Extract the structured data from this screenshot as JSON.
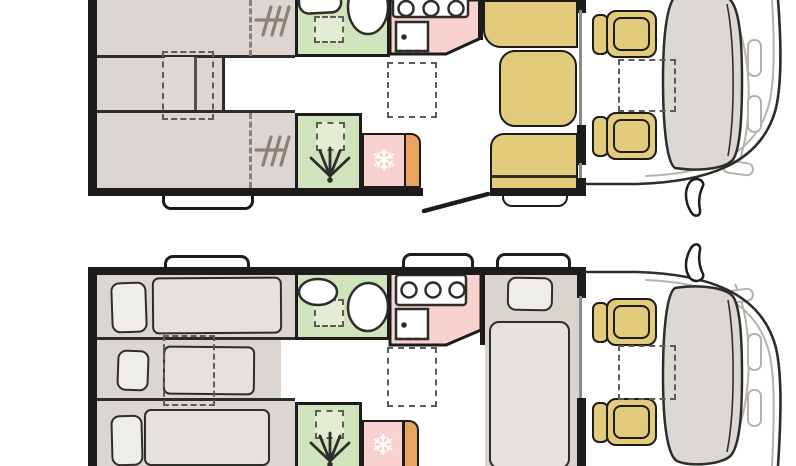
{
  "colors": {
    "wall": "#1e1c1a",
    "ink": "#2f2d2a",
    "bed_base": "#dbd6d1",
    "bed_base2": "#d9d4ce",
    "mattress": "#e6e1dc",
    "pillow": "#efedea",
    "bath_green": "#cfe3bc",
    "bath_green_light": "#e2edd4",
    "kitchen_pink": "#f7d2cf",
    "fridge_orange": "#e9a45f",
    "seat_yellow": "#e3cb7c",
    "windshield": "#dcd9d5",
    "outline_light": "#b6b2ae",
    "dash": "#5f5b57",
    "heater": "#8a8178",
    "divider": "#8b8b8b"
  },
  "icons": {
    "snowflake": "❄",
    "shower_spray": "fan-of-lines-with-drain-dot",
    "heater": "hatch-tally-lines",
    "stove": "three-burner-rings",
    "wing_mirror": "black-outline-blade"
  },
  "plans": [
    {
      "id": "floor-plan-top"
    },
    {
      "id": "floor-plan-bottom"
    }
  ]
}
